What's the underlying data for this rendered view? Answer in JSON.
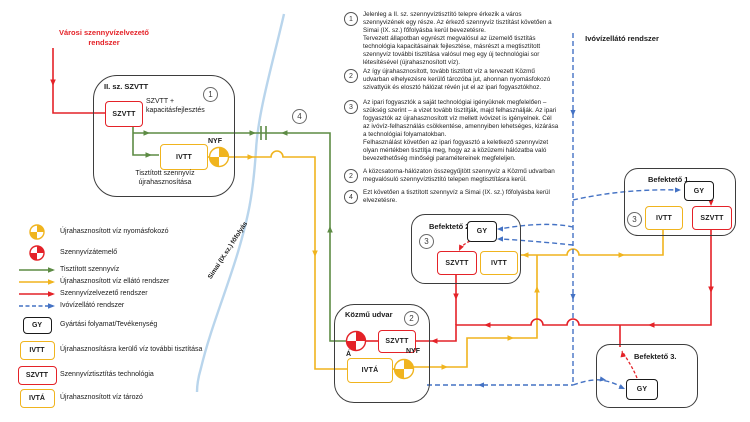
{
  "colors": {
    "red": "#e42228",
    "yellow": "#f0b41e",
    "green": "#5d8b44",
    "blue": "#4472c4",
    "river": "#b9d5ec",
    "box_border": "#3d3d3d"
  },
  "diagram": {
    "city_label": "Városi szennyvízelvezető rendszer",
    "drinking_label": "Ivóvízellátó rendszer",
    "river_label": "Simai (IX.sz.) főfolyás",
    "crossing_num": "4",
    "plant": {
      "title": "II. sz. SZVTT",
      "num": "1",
      "szvtt": "SZVTT",
      "desc": "SZVTT + kapacitásfejlesztés",
      "ivtt": "IVTT",
      "nyf": "NYF",
      "caption": "Tisztított szennyvíz újrahasznosítása"
    },
    "kozmu": {
      "title": "Közmű udvar",
      "num": "2",
      "a": "Á",
      "szvtt": "SZVTT",
      "ivta": "IVTÁ",
      "nyf": "NYF"
    },
    "bef1": {
      "title": "Befektető 1.",
      "num": "3",
      "gy": "GY",
      "ivtt": "IVTT",
      "szvtt": "SZVTT"
    },
    "bef2": {
      "title": "Befektető 2.",
      "num": "3",
      "gy": "GY",
      "szvtt": "SZVTT",
      "ivtt": "IVTT"
    },
    "bef3": {
      "title": "Befektető 3.",
      "gy": "GY"
    }
  },
  "notes": [
    {
      "num": "1",
      "text": "Jelenleg a II. sz. szennyvíztisztító telepre érkezik a város szennyvizének egy része. Az érkező szennyvíz tisztítást követően a Simai (IX. sz.) főfolyásba kerül bevezetésre.\nTervezett állapotban egyrészt megvalósul az üzemelő tisztítás technológia kapacitásainak fejlesztése, másrészt a megtisztított szennyvíz további tisztítása valósul meg egy új technológiai sor létesítésével (újrahasznosított víz)."
    },
    {
      "num": "2",
      "text": "Az így újrahasznosított, tovább tisztított víz a tervezett Közmű udvarban elhelyezésre kerülő tározóba jut, ahonnan nyomásfokozó szivattyúk és elosztó hálózat révén jut el az ipari fogyasztókhoz."
    },
    {
      "num": "3",
      "text": "Az ipari fogyasztók a saját technológiai igényüknek megfelelően – szükség szerint – a vizet tovább tisztítják, majd felhasználják. Az ipari fogyasztók az újrahasznosított víz mellett ivóvizet is igényelnek. Cél az ivóvíz-felhasználás csökkentése, amennyiben lehetséges, kizárása a technológiai folyamatokban.\nFelhasználást követően az ipari fogyasztó a keletkező szennyvizet olyan mértékben tisztítja meg, hogy az a közüzemi hálózatba való bevezethetőség minőségi paramétereinek megfeleljen."
    },
    {
      "num": "2",
      "text": "A közcsatorna-hálózaton összegyűjtött szennyvíz a Közmű udvarban megvalósuló szennyvíztisztító telepen megtisztításra kerül."
    },
    {
      "num": "4",
      "text": "Ezt követően a tisztított szennyvíz a Simai (IX. sz.) főfolyásba kerül elvezetésre."
    }
  ],
  "legend": [
    {
      "label": "Újrahasznosított víz nyomásfokozó"
    },
    {
      "label": "Szennyvízátemelő"
    },
    {
      "label": "Tisztított szennyvíz"
    },
    {
      "label": "Újrahasznosított víz ellátó rendszer"
    },
    {
      "label": "Szennyvízelvezető rendszer"
    },
    {
      "label": "Ivóvízellátó rendszer"
    },
    {
      "box": "GY",
      "label": "Gyártási folyamat/Tevékenység"
    },
    {
      "box": "IVTT",
      "label": "Újrahasznosításra kerülő víz további tisztítása"
    },
    {
      "box": "SZVTT",
      "label": "Szennyvíztisztítás technológia"
    },
    {
      "box": "IVTÁ",
      "label": "Újrahasznosított víz tározó"
    }
  ]
}
